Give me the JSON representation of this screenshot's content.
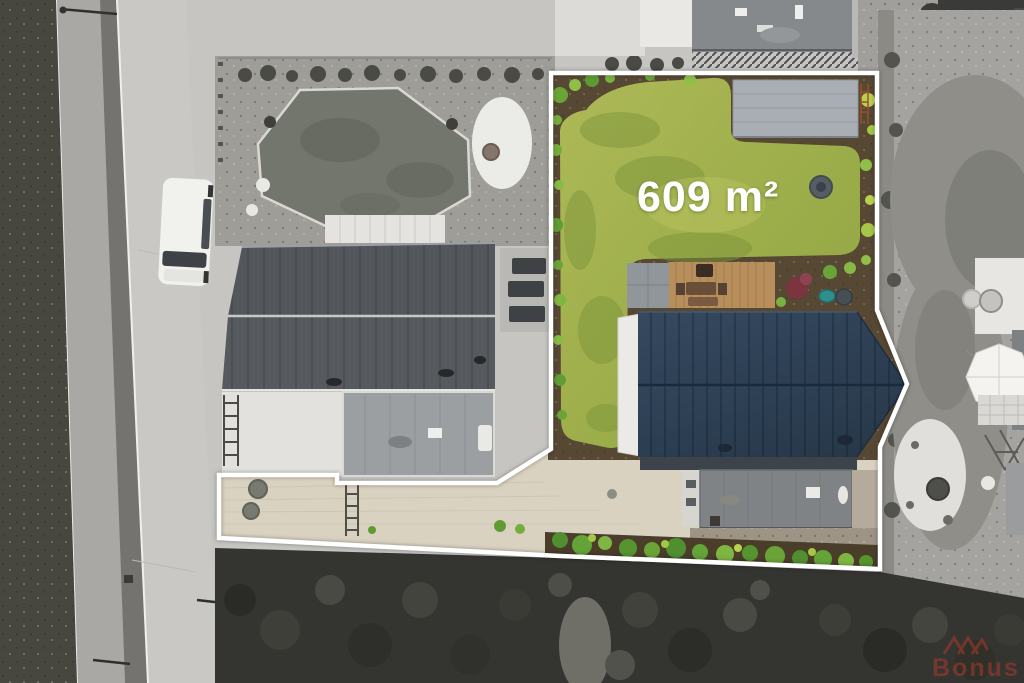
{
  "photo": {
    "kind": "aerial-drone-photo",
    "subject": "building plot highlighted in color inside grayscale surroundings",
    "area_label": "609 m²",
    "boundary_color": "#ffffff"
  },
  "watermark": {
    "text": "Bonus",
    "color": "#b23a2c"
  },
  "palette": {
    "lawn_green": "#9fb14c",
    "roof_navy": "#2f4258",
    "deck_wood": "#b88f5c",
    "paver_pad": "#a8aeb3",
    "driveway": "#d9d2c1",
    "hedge_green": "#63a338",
    "surroundings": "grayscale"
  }
}
